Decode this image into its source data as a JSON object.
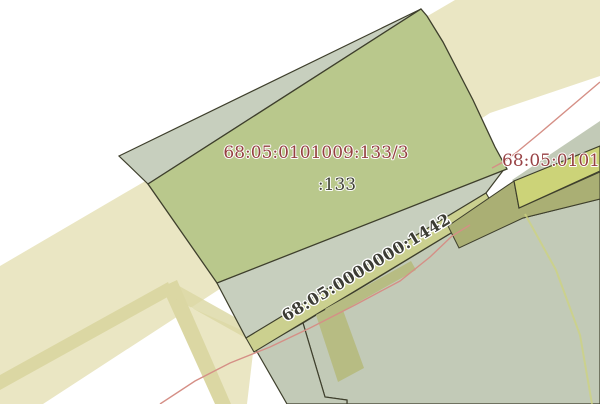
{
  "map": {
    "labels": {
      "parcel_main": "68:05:0101009:133/3",
      "parcel_main_short": ":133",
      "road_parcel": "68:05:0000000:1442",
      "parcel_right": "68:05:010100"
    },
    "colors": {
      "background": "#ffffff",
      "road_fill": "#eae6c3",
      "road_stripe": "#dbd7a3",
      "parcel_green": "#b9c88c",
      "parcel_gray": "#c7cfbe",
      "parcel_gray_dark": "#c2cab7",
      "strip_olive": "#cbd08f",
      "band_olive": "#aaaf74",
      "parcel_yellow": "#ccd378",
      "patch_olive": "#b7bc83",
      "border_dark": "#3e3f2c",
      "line_pink": "#d58f86",
      "line_yellow": "#cdd37f",
      "label_maroon": "#943b3e",
      "label_dark": "#3c3c34"
    }
  }
}
